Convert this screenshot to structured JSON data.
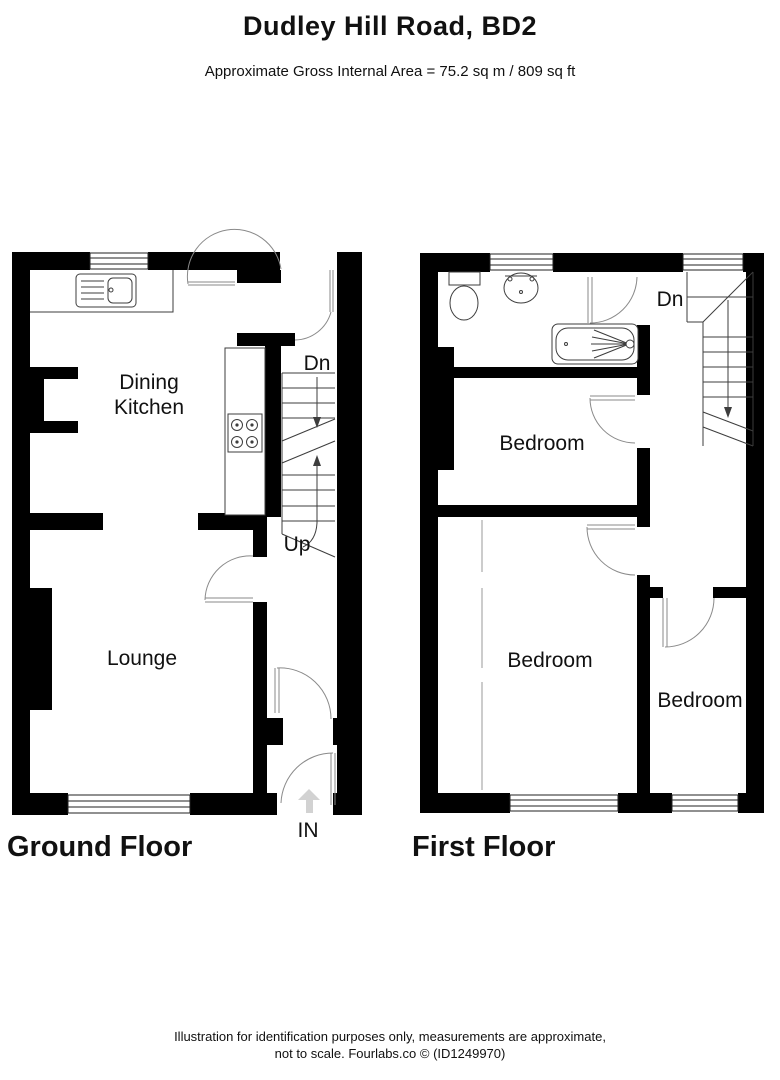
{
  "header": {
    "title": "Dudley Hill Road, BD2",
    "subtitle": "Approximate Gross Internal Area = 75.2 sq m / 809 sq ft"
  },
  "ground_floor": {
    "title": "Ground Floor",
    "rooms": {
      "dining_kitchen_line1": "Dining",
      "dining_kitchen_line2": "Kitchen",
      "lounge": "Lounge"
    },
    "stairs": {
      "down_label": "Dn",
      "up_label": "Up"
    },
    "entrance_label": "IN"
  },
  "first_floor": {
    "title": "First Floor",
    "rooms": {
      "bedroom1": "Bedroom",
      "bedroom2": "Bedroom",
      "bedroom3": "Bedroom"
    },
    "stairs": {
      "down_label": "Dn"
    }
  },
  "footer": {
    "line1": "Illustration for identification purposes only, measurements are approximate,",
    "line2": "not to scale. Fourlabs.co © (ID1249970)"
  },
  "colors": {
    "wall": "#000000",
    "line": "#3d3d3d",
    "door_arc": "#8a8a8a",
    "entry_arrow": "#d2d2d2"
  }
}
